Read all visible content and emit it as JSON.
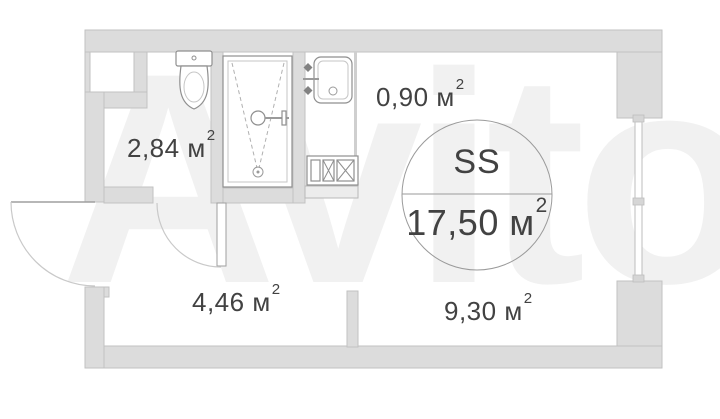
{
  "watermark": "Avito",
  "unit_circle": {
    "type_label": "SS",
    "area": "17,50 м",
    "area_sup": "2"
  },
  "areas": {
    "bathroom": {
      "text": "2,84 м",
      "sup": "2"
    },
    "kitchen_niche": {
      "text": "0,90 м",
      "sup": "2"
    },
    "hallway": {
      "text": "4,46 м",
      "sup": "2"
    },
    "living": {
      "text": "9,30 м",
      "sup": "2"
    }
  },
  "colors": {
    "wall_fill": "#dcdcdc",
    "wall_edge": "#c2c2c2",
    "fixture_line": "#8f8f8f",
    "text": "#424242",
    "watermark": "#f1f1f1",
    "background": "#ffffff"
  }
}
